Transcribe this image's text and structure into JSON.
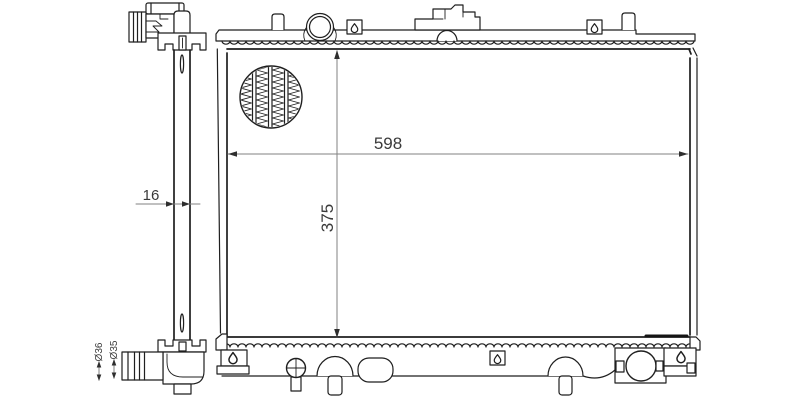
{
  "drawing": {
    "labels": {
      "core_width": "598",
      "core_height": "375",
      "tank_depth": "16",
      "outlet_dia_outer": "Ø36",
      "outlet_dia_inner": "Ø35"
    },
    "colors": {
      "background": "#ffffff",
      "outline": "#1f1f1f",
      "dimension_line": "#828282",
      "dimension_text": "#3a3a3a"
    }
  }
}
